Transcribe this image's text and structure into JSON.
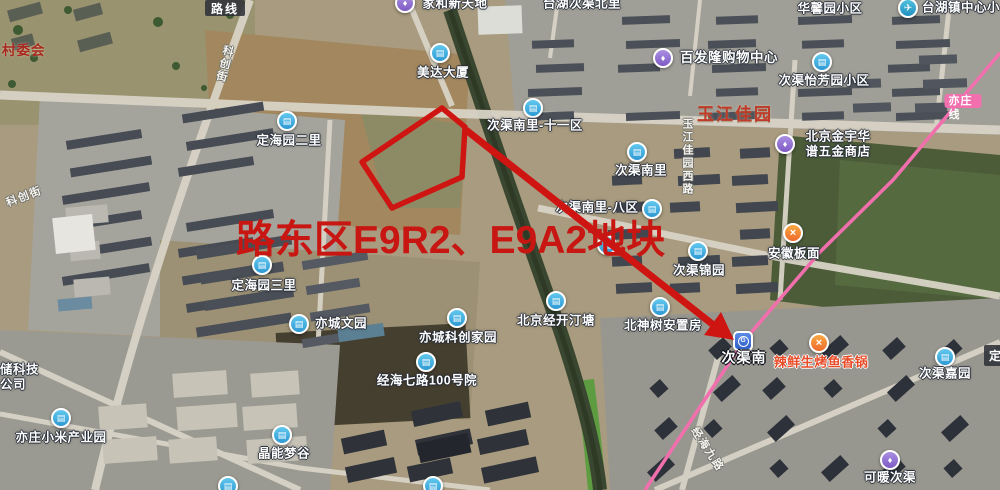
{
  "map": {
    "controls": {
      "route_button": "路线",
      "partial_button": "定"
    },
    "annotation": {
      "text": "路东区E9R2、E9A2地块",
      "color": "#c81712",
      "polygon_points": "442,108 465,127 462,177 392,208 362,162",
      "arrow_shaft_points": "466,130 716,327",
      "arrow_head_points": "734,340 704,335 721,312"
    },
    "subway": {
      "line_label": "亦庄线",
      "line_color": "#f26fae",
      "line_points": "1000,53 893,180 820,252 743,342 645,490",
      "badge_x": 963,
      "badge_y": 101
    },
    "pois": [
      {
        "t": "村委会",
        "s": "maroon",
        "tx": 2,
        "ty": 51,
        "anchor": "left"
      },
      {
        "t": "家和新天地",
        "s": "white",
        "icon": "purple",
        "ix": 405,
        "iy": 3,
        "tx": 455,
        "ty": 4
      },
      {
        "t": "台湖次渠北里",
        "s": "white",
        "tx": 582,
        "ty": 4
      },
      {
        "t": "华馨园小区",
        "s": "white",
        "tx": 830,
        "ty": 9
      },
      {
        "t": "台湖镇中心小",
        "s": "white",
        "icon": "plane",
        "ix": 908,
        "iy": 8,
        "tx": 922,
        "ty": 8,
        "anchor": "left"
      },
      {
        "t": "美达大厦",
        "s": "white",
        "icon": "blue",
        "ix": 440,
        "iy": 53,
        "tx": 443,
        "ty": 73
      },
      {
        "t": "次渠南里-十一区",
        "s": "white",
        "icon": "blue",
        "ix": 533,
        "iy": 108,
        "tx": 535,
        "ty": 126
      },
      {
        "t": "百发隆购物中心",
        "s": "white14",
        "icon": "purple",
        "ix": 663,
        "iy": 58,
        "tx": 729,
        "ty": 58
      },
      {
        "t": "次渠怡芳园小区",
        "s": "white",
        "icon": "blue",
        "ix": 822,
        "iy": 62,
        "tx": 824,
        "ty": 81
      },
      {
        "t": "玉江佳园",
        "s": "redbig",
        "tx": 735,
        "ty": 115
      },
      {
        "t": "北京金宇华\n谱五金商店",
        "s": "white",
        "icon": "purple",
        "ix": 785,
        "iy": 144,
        "tx": 838,
        "ty": 144
      },
      {
        "t": "次渠南里",
        "s": "white",
        "icon": "blue",
        "ix": 637,
        "iy": 152,
        "tx": 641,
        "ty": 171
      },
      {
        "t": "次渠南里-八区",
        "s": "white",
        "icon": "blue",
        "ix": 652,
        "iy": 209,
        "tx": 597,
        "ty": 208
      },
      {
        "t": "",
        "icon": "blue",
        "ix": 607,
        "iy": 245
      },
      {
        "t": "次渠锦园",
        "s": "white",
        "icon": "blue",
        "ix": 698,
        "iy": 251,
        "tx": 699,
        "ty": 271
      },
      {
        "t": "安徽板面",
        "s": "white",
        "icon": "orange",
        "ix": 793,
        "iy": 233,
        "tx": 794,
        "ty": 254
      },
      {
        "t": "定海园二里",
        "s": "white",
        "icon": "blue",
        "ix": 287,
        "iy": 121,
        "tx": 289,
        "ty": 141
      },
      {
        "t": "定海园三里",
        "s": "white",
        "icon": "blue",
        "ix": 262,
        "iy": 265,
        "tx": 264,
        "ty": 286
      },
      {
        "t": "亦城文园",
        "s": "white",
        "icon": "blue",
        "ix": 299,
        "iy": 324,
        "tx": 341,
        "ty": 324
      },
      {
        "t": "亦城科创家园",
        "s": "white",
        "icon": "blue",
        "ix": 457,
        "iy": 318,
        "tx": 458,
        "ty": 338
      },
      {
        "t": "北京经开汀塘",
        "s": "white",
        "icon": "blue",
        "ix": 556,
        "iy": 301,
        "tx": 556,
        "ty": 321
      },
      {
        "t": "北神树安置房",
        "s": "white",
        "icon": "blue",
        "ix": 660,
        "iy": 307,
        "tx": 663,
        "ty": 326
      },
      {
        "t": "经海七路100号院",
        "s": "white",
        "icon": "blue",
        "ix": 426,
        "iy": 362,
        "tx": 427,
        "ty": 381
      },
      {
        "t": "次渠南",
        "s": "station",
        "icon": "metro",
        "ix": 743,
        "iy": 341,
        "tx": 744,
        "ty": 358
      },
      {
        "t": "辣鲜生烤鱼香锅",
        "s": "orangetext",
        "icon": "orange",
        "ix": 819,
        "iy": 343,
        "tx": 821,
        "ty": 362
      },
      {
        "t": "次渠嘉园",
        "s": "white",
        "icon": "blue",
        "ix": 945,
        "iy": 357,
        "tx": 945,
        "ty": 374
      },
      {
        "t": "可暖次渠",
        "s": "white",
        "icon": "purple",
        "ix": 890,
        "iy": 460,
        "tx": 890,
        "ty": 478
      },
      {
        "t": "晶能梦谷",
        "s": "white",
        "icon": "blue",
        "ix": 282,
        "iy": 435,
        "tx": 284,
        "ty": 454
      },
      {
        "t": "亦庄小米产业园",
        "s": "white",
        "icon": "blue",
        "ix": 61,
        "iy": 418,
        "tx": 61,
        "ty": 438
      },
      {
        "t": "储科技\n公司",
        "s": "white",
        "tx": 0,
        "ty": 377,
        "anchor": "left"
      },
      {
        "t": "",
        "icon": "blue",
        "ix": 228,
        "iy": 486
      },
      {
        "t": "",
        "icon": "blue",
        "ix": 433,
        "iy": 486
      }
    ],
    "road_labels": [
      {
        "t": "玉江佳园西路",
        "mode": "v",
        "x": 687,
        "y": 157,
        "rot": 0
      },
      {
        "t": "科创街",
        "mode": "v",
        "x": 224,
        "y": 64,
        "rot": 14
      },
      {
        "t": "科创街",
        "mode": "h",
        "x": 24,
        "y": 196,
        "rot": -21
      },
      {
        "t": "经海九路",
        "mode": "h",
        "x": 708,
        "y": 449,
        "rot": 57
      }
    ],
    "icon_legend": {
      "blue": "building-poi-icon",
      "purple": "shopping-poi-icon",
      "orange": "food-poi-icon",
      "plane": "school-poi-icon",
      "metro": "subway-station-icon"
    }
  }
}
